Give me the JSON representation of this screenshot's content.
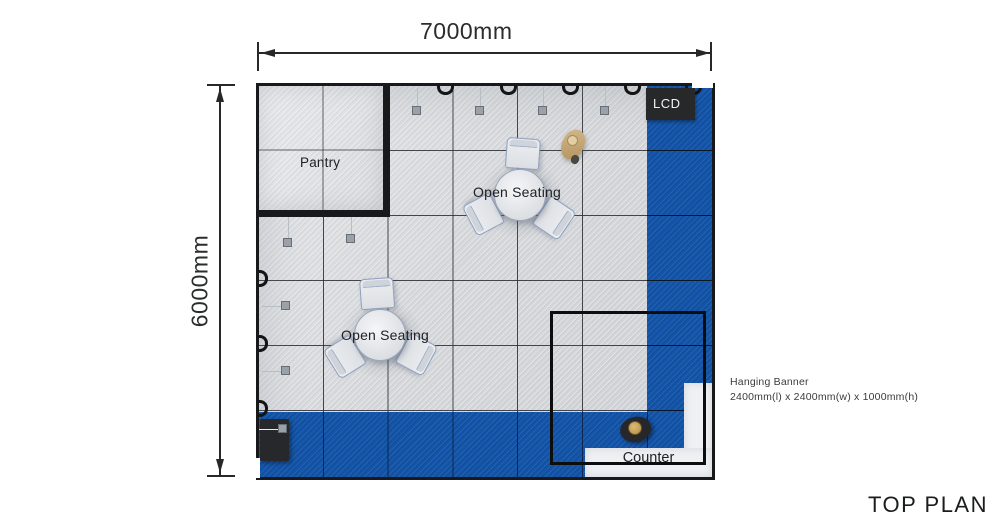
{
  "title": "TOP PLAN",
  "dimensions": {
    "width_label": "7000mm",
    "height_label": "6000mm"
  },
  "areas": {
    "pantry": "Pantry",
    "open_seating": "Open Seating",
    "lcd": "LCD",
    "counter": "Counter"
  },
  "annotations": {
    "hanging_banner_title": "Hanging Banner",
    "hanging_banner_spec": "2400mm(l) x 2400mm(w) x 1000mm(h)"
  },
  "legend": {
    "carpet_color": "#1254a9",
    "floor_color": "#d8dadc",
    "wall_color": "#17191b",
    "counter_color": "#eef0f2"
  }
}
